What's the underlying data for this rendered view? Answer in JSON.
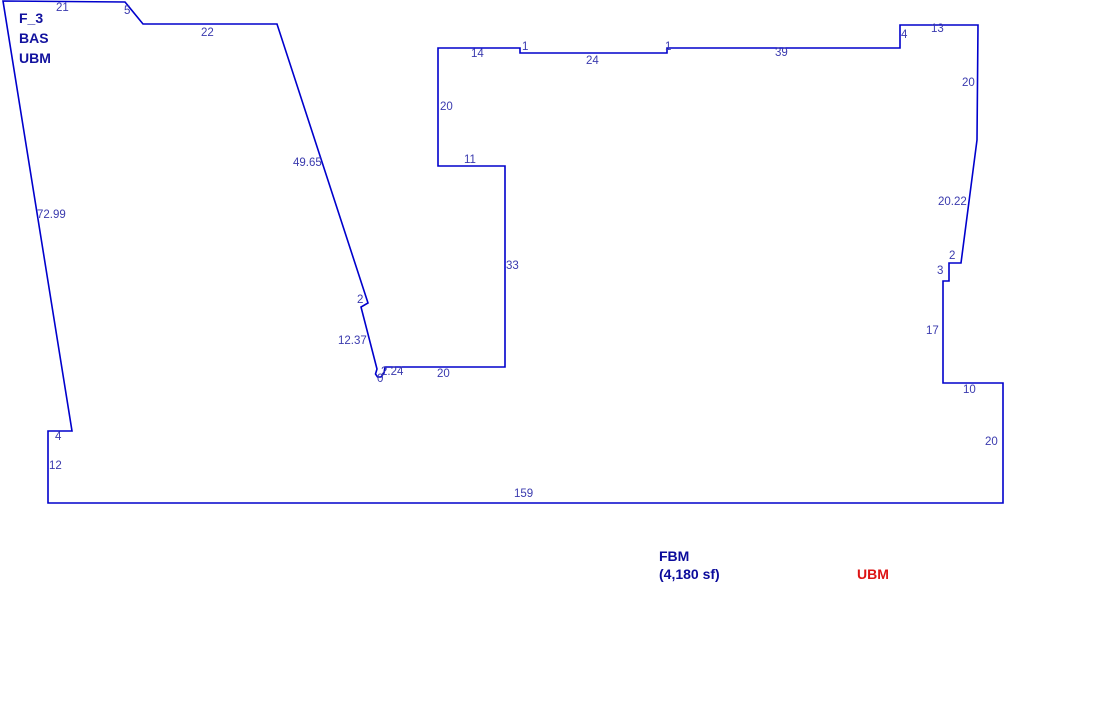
{
  "canvas": {
    "width": 1097,
    "height": 719,
    "background": "#ffffff"
  },
  "colors": {
    "outline": "#0000cc",
    "dimension_text": "#3a3aae",
    "title_text": "#12129e",
    "fbm_text": "#0b0b9b",
    "ubm_text": "#dd1414"
  },
  "sketch": {
    "area_title": {
      "lines": [
        "F_3",
        "BAS",
        "UBM"
      ],
      "x": 19,
      "y": 23,
      "line_height": 20
    },
    "outline_points": [
      [
        3,
        1
      ],
      [
        125,
        2
      ],
      [
        143,
        24
      ],
      [
        277,
        24
      ],
      [
        368,
        303
      ],
      [
        361,
        307
      ],
      [
        377,
        369
      ],
      [
        375.5,
        374
      ],
      [
        377.5,
        377
      ],
      [
        381,
        377
      ],
      [
        384,
        373
      ],
      [
        385,
        367
      ],
      [
        505,
        367
      ],
      [
        505,
        166
      ],
      [
        438,
        166
      ],
      [
        438,
        48
      ],
      [
        520,
        48
      ],
      [
        520,
        53
      ],
      [
        667,
        53
      ],
      [
        667,
        48
      ],
      [
        900,
        48
      ],
      [
        900,
        25
      ],
      [
        978,
        25
      ],
      [
        977,
        140
      ],
      [
        961,
        263
      ],
      [
        949,
        263
      ],
      [
        949,
        281
      ],
      [
        943,
        281
      ],
      [
        943,
        383
      ],
      [
        1003,
        383
      ],
      [
        1003,
        503
      ],
      [
        48,
        503
      ],
      [
        48,
        431
      ],
      [
        72,
        431
      ]
    ],
    "dimension_labels": [
      {
        "text": "21",
        "x": 56,
        "y": 11
      },
      {
        "text": "5",
        "x": 124,
        "y": 14
      },
      {
        "text": "22",
        "x": 201,
        "y": 36
      },
      {
        "text": "49.65",
        "x": 293,
        "y": 166
      },
      {
        "text": "72.99",
        "x": 37,
        "y": 218
      },
      {
        "text": "2",
        "x": 357,
        "y": 303
      },
      {
        "text": "12.37",
        "x": 338,
        "y": 344
      },
      {
        "text": "2.24",
        "x": 381,
        "y": 375
      },
      {
        "text": "0",
        "x": 377,
        "y": 382
      },
      {
        "text": "20",
        "x": 437,
        "y": 377
      },
      {
        "text": "33",
        "x": 506,
        "y": 269
      },
      {
        "text": "11",
        "x": 464,
        "y": 163
      },
      {
        "text": "20",
        "x": 440,
        "y": 110
      },
      {
        "text": "14",
        "x": 471,
        "y": 57
      },
      {
        "text": "1",
        "x": 522,
        "y": 50
      },
      {
        "text": "24",
        "x": 586,
        "y": 64
      },
      {
        "text": "1",
        "x": 665,
        "y": 50
      },
      {
        "text": "39",
        "x": 775,
        "y": 56
      },
      {
        "text": "4",
        "x": 901,
        "y": 38
      },
      {
        "text": "13",
        "x": 931,
        "y": 32
      },
      {
        "text": "20",
        "x": 962,
        "y": 86
      },
      {
        "text": "20.22",
        "x": 938,
        "y": 205
      },
      {
        "text": "2",
        "x": 949,
        "y": 259
      },
      {
        "text": "3",
        "x": 937,
        "y": 274
      },
      {
        "text": "17",
        "x": 926,
        "y": 334
      },
      {
        "text": "10",
        "x": 963,
        "y": 393
      },
      {
        "text": "20",
        "x": 985,
        "y": 445
      },
      {
        "text": "159",
        "x": 514,
        "y": 497
      },
      {
        "text": "12",
        "x": 49,
        "y": 469
      },
      {
        "text": "4",
        "x": 55,
        "y": 440
      }
    ],
    "footer": {
      "fbm_label": "FBM",
      "fbm_area": "(4,180 sf)",
      "ubm_label": "UBM",
      "fbm_x": 659,
      "fbm_y": 561,
      "fbm_area_y": 579,
      "ubm_x": 857,
      "ubm_y": 579
    }
  }
}
